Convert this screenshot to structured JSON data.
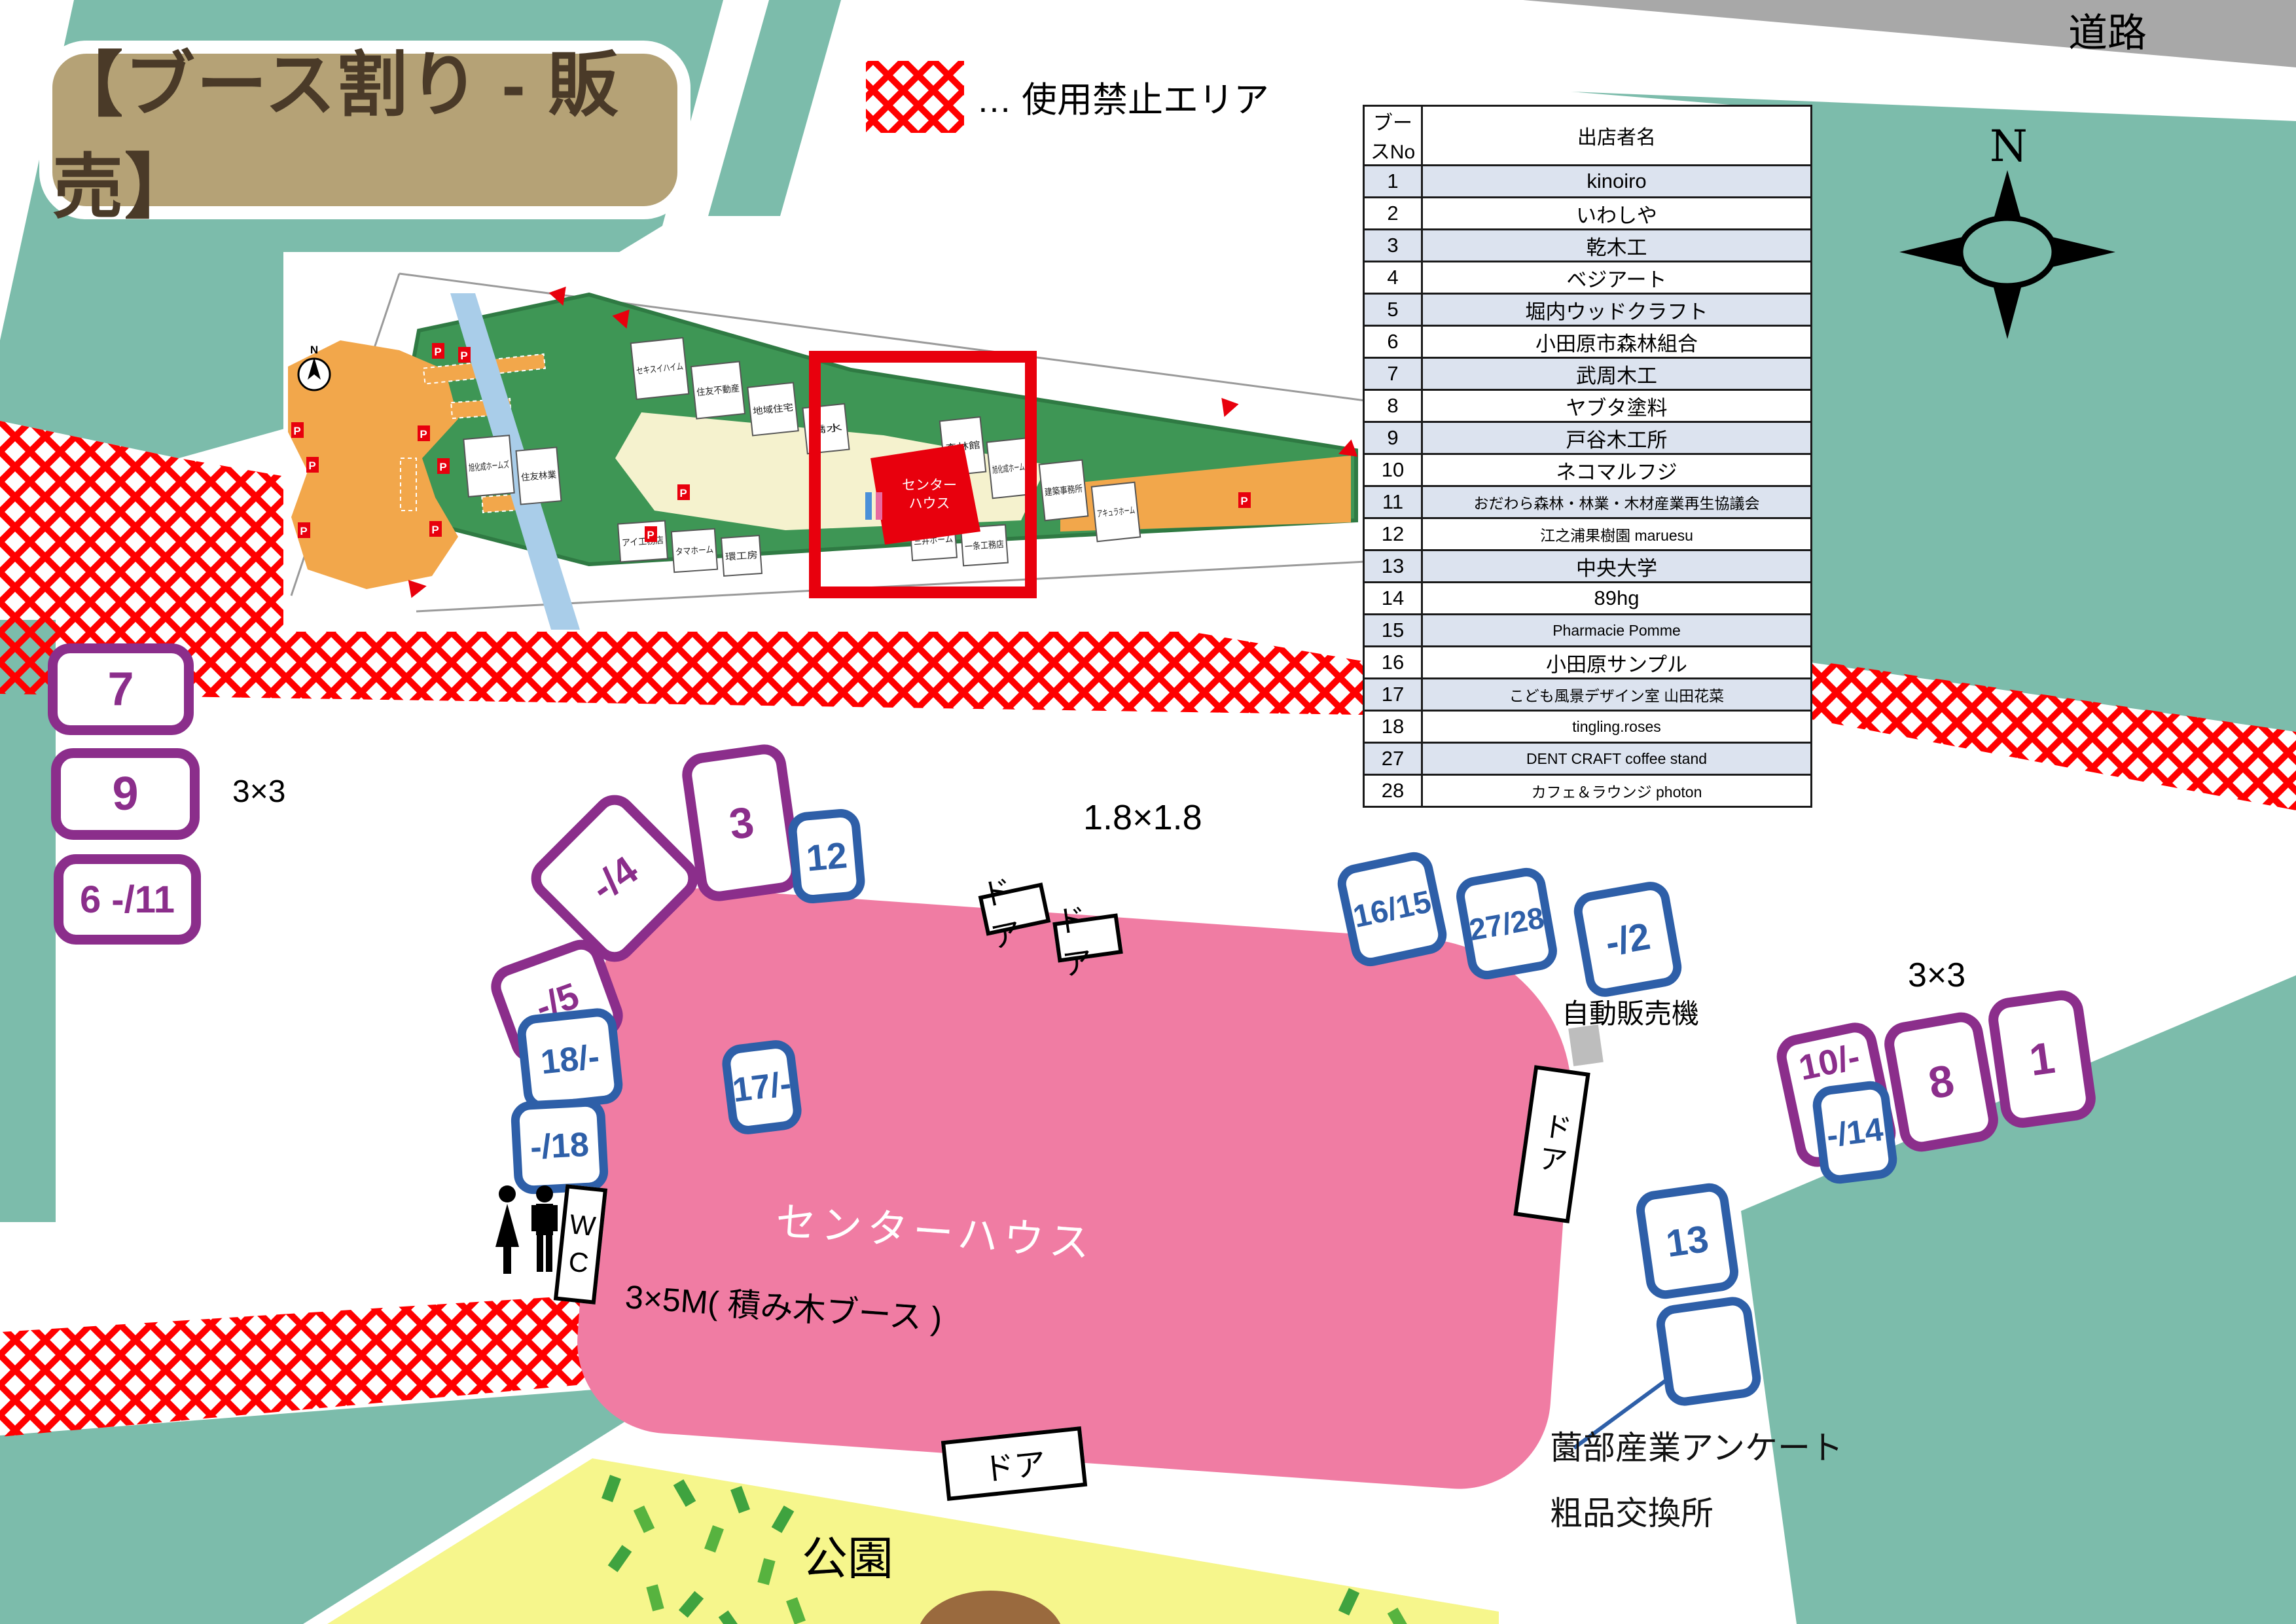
{
  "page": {
    "title": "【ブース割り - 販売】"
  },
  "legend": {
    "text": "… 使用禁止エリア"
  },
  "road": {
    "label": "道路"
  },
  "compass": {
    "label": "N"
  },
  "vendors_table": {
    "headers": [
      "ブースNo",
      "出店者名"
    ],
    "rows": [
      [
        "1",
        "kinoiro"
      ],
      [
        "2",
        "いわしや"
      ],
      [
        "3",
        "乾木工"
      ],
      [
        "4",
        "ベジアート"
      ],
      [
        "5",
        "堀内ウッドクラフト"
      ],
      [
        "6",
        "小田原市森林組合"
      ],
      [
        "7",
        "武周木工"
      ],
      [
        "8",
        "ヤブタ塗料"
      ],
      [
        "9",
        "戸谷木工所"
      ],
      [
        "10",
        "ネコマルフジ"
      ],
      [
        "11",
        "おだわら森林・林業・木材産業再生協議会"
      ],
      [
        "12",
        "江之浦果樹園  maruesu"
      ],
      [
        "13",
        "中央大学"
      ],
      [
        "14",
        "89hg"
      ],
      [
        "15",
        "Pharmacie Pomme"
      ],
      [
        "16",
        "小田原サンプル"
      ],
      [
        "17",
        "こども風景デザイン室  山田花菜"
      ],
      [
        "18",
        "tingling.roses"
      ],
      [
        "27",
        "DENT CRAFT coffee stand"
      ],
      [
        "28",
        "カフェ＆ラウンジ  photon"
      ]
    ]
  },
  "booths": {
    "b7": "7",
    "b9": "9",
    "b6_11": "6 -/11",
    "d4": "-/4",
    "d5": "-/5",
    "b3": "3",
    "b12": "12",
    "b16_15": "16/15",
    "b27_28": "27/28",
    "b2": "-/2",
    "b18a": "18/-",
    "b18b": "-/18",
    "b17": "17/-",
    "b13": "13",
    "b10": "10/-",
    "b14": "-/14",
    "b8": "8",
    "b1": "1"
  },
  "site_labels": {
    "size_3x3_left": "3×3",
    "size_3x3_right": "3×3",
    "size_1_8": "1.8×1.8",
    "tsumiki": "3×5M( 積み木ブース )",
    "center_house": "センターハウス",
    "vending": "自動販売機",
    "wc": "W\nC",
    "park": "公園",
    "door": "ドア",
    "annotation_l1": "薗部産業アンケート",
    "annotation_l2": "粗品交換所"
  },
  "inset_map": {
    "n": "N",
    "p_label": "P",
    "center_house_l1": "センター",
    "center_house_l2": "ハウス",
    "lots": [
      {
        "label": "セキスイハイム"
      },
      {
        "label": "住友不動産"
      },
      {
        "label": "地域住宅"
      },
      {
        "label": "橋水"
      },
      {
        "label": "森林館"
      },
      {
        "label": "旭化成ホームズ"
      },
      {
        "label": "建築事務所"
      },
      {
        "label": "アキュラホーム"
      },
      {
        "label": "旭化成ホームズ"
      },
      {
        "label": "住友林業"
      },
      {
        "label": "アイ工務店"
      },
      {
        "label": "タマホーム"
      },
      {
        "label": "環工房"
      },
      {
        "label": "三井ホーム"
      },
      {
        "label": "一条工務店"
      }
    ]
  },
  "colors": {
    "teal": "#7CBCAB",
    "pink": "#F07CA3",
    "purple": "#8B2E8B",
    "blue": "#2E5FA8",
    "red": "#FF0000",
    "tan": "#B5A276",
    "title_text": "#4A3A28",
    "road_gray": "#A8A8A8",
    "park_yellow": "#F6F68C",
    "leaf_green": "#3FA33F",
    "table_alt": "#DCE3EF",
    "map_green": "#3E9655",
    "map_orange": "#F2A74B",
    "river_blue": "#A9CDE9",
    "mound_brown": "#9A6A3E"
  }
}
